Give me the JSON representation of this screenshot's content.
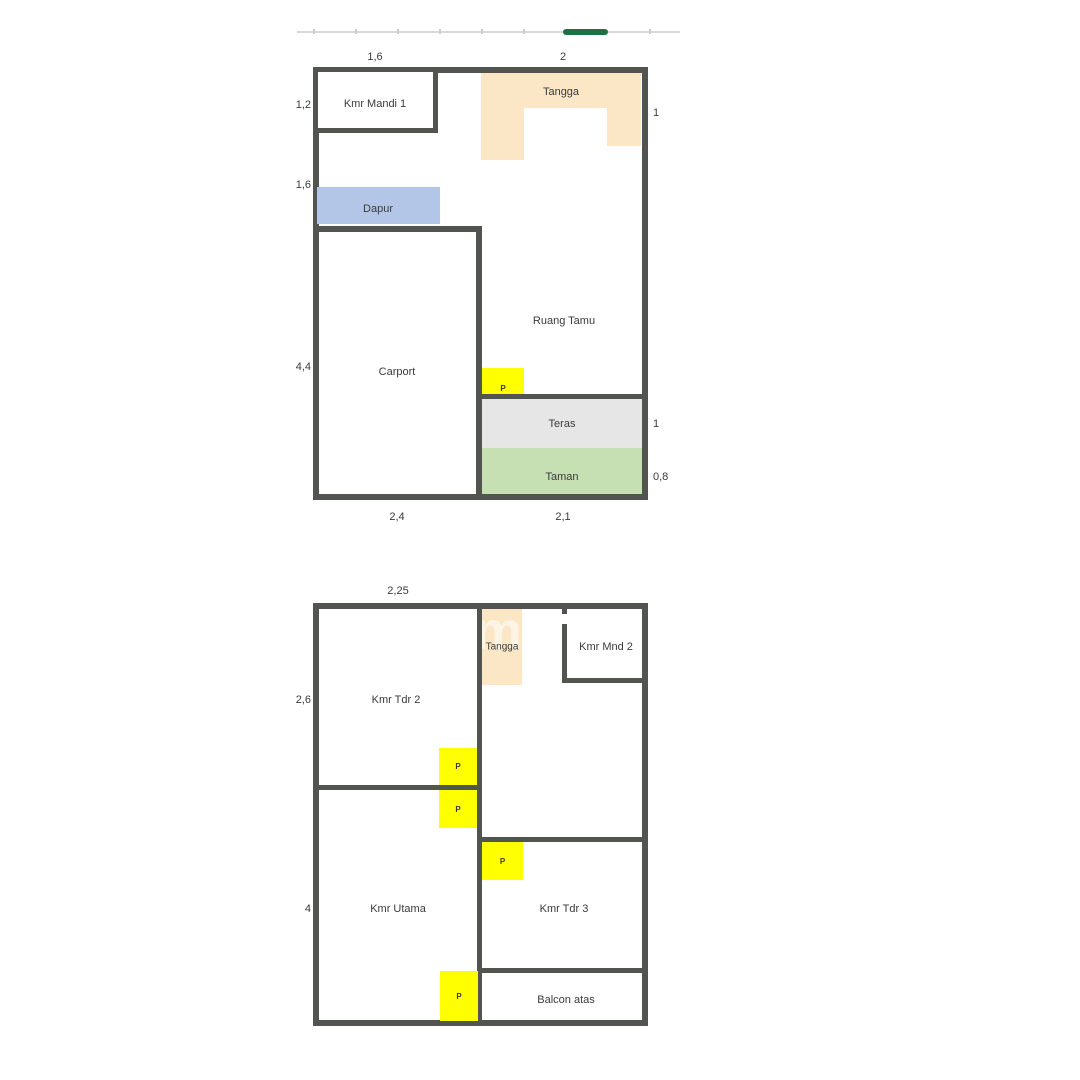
{
  "colors": {
    "wall": "#525450",
    "stairs": "#fbe7c5",
    "kitchen": "#b4c6e7",
    "terrace": "#e7e6e6",
    "garden": "#c6e0b4",
    "door": "#ffff00",
    "scroll_thumb": "#1e7145",
    "scroll_track": "#d9d9d9",
    "text": "#3a3a3a"
  },
  "doors": {
    "label": "P"
  },
  "watermark": {
    "text": "m"
  },
  "floor1": {
    "rooms": {
      "bath": "Kmr Mandi 1",
      "stairs": "Tangga",
      "kitchen": "Dapur",
      "carport": "Carport",
      "living": "Ruang Tamu",
      "terrace": "Teras",
      "garden": "Taman"
    },
    "dims": {
      "top_bath": "1,6",
      "top_stairs": "2",
      "left_bath": "1,2",
      "left_kitchen": "1,6",
      "left_carport": "4,4",
      "right_stairs": "1",
      "right_terrace": "1",
      "right_garden": "0,8",
      "bottom_carport": "2,4",
      "bottom_terrace": "2,1"
    }
  },
  "floor2": {
    "rooms": {
      "bed2": "Kmr Tdr 2",
      "stairs": "Tangga",
      "bath2": "Kmr Mnd 2",
      "master": "Kmr Utama",
      "bed3": "Kmr Tdr 3",
      "balcony": "Balcon atas"
    },
    "dims": {
      "top_bed2": "2,25",
      "left_bed2": "2,6",
      "left_master": "4"
    }
  }
}
